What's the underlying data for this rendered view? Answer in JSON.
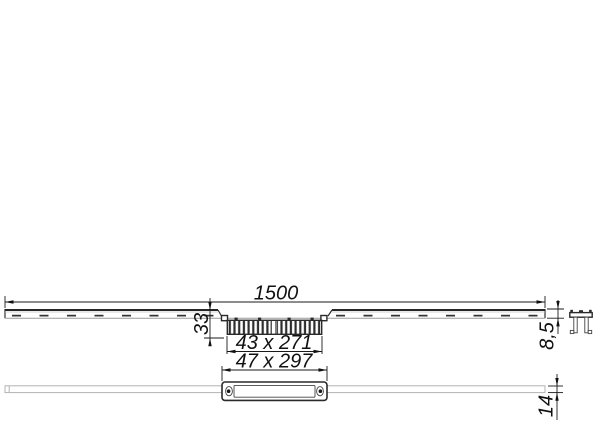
{
  "dimensions": {
    "length": "1500",
    "depth": "33",
    "grate": "43 x 271",
    "frame": "47 x 297",
    "profile_height": "8,5",
    "body_height": "14"
  },
  "colors": {
    "background": "#ffffff",
    "line": "#2e2e2e",
    "light_line": "#b3b3b3",
    "dimension": "#1a1a1a"
  }
}
